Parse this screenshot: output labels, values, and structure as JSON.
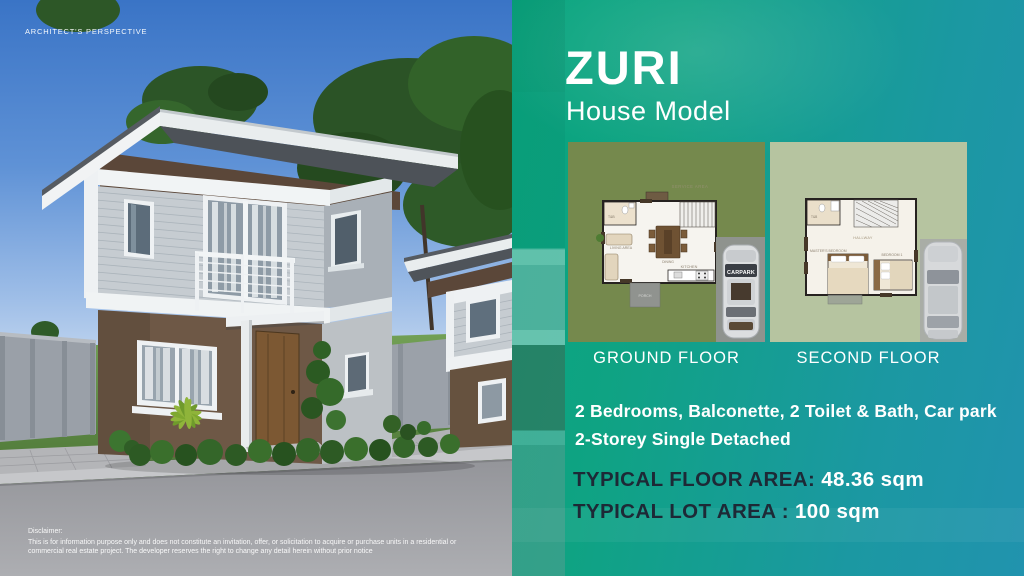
{
  "colors": {
    "panel_gradient_start": "#07a57d",
    "panel_gradient_end": "#2193ae",
    "area_label_dark": "#1d2936",
    "sky_blue": "#3a74c6",
    "ground_plan_bg": "#75894d",
    "second_plan_bg": "#b6c4a0"
  },
  "left_panel": {
    "corner_label": "ARCHITECT'S PERSPECTIVE",
    "disclaimer_title": "Disclaimer:",
    "disclaimer_body": "This is for information purpose only and does not constitute an invitation, offer, or solicitation to acquire or purchase units in a residential or commercial real estate project. The developer reserves the right to change any detail herein without prior notice"
  },
  "right_panel": {
    "title": "ZURI",
    "subtitle": "House Model",
    "floor_plans": [
      {
        "label": "GROUND FLOOR",
        "rooms": {
          "service": "SERVICE AREA",
          "tb": "T&B",
          "living": "LIVING AREA",
          "dining": "DINING",
          "kitchen": "KITCHEN",
          "porch": "PORCH",
          "carpark": "CARPARK"
        }
      },
      {
        "label": "SECOND FLOOR",
        "rooms": {
          "tb": "T&B",
          "hallway": "HALLWAY",
          "master": "MASTER'S BEDROOM",
          "bedroom1": "BEDROOM 1"
        }
      }
    ],
    "features": [
      "2 Bedrooms, Balconette, 2 Toilet & Bath, Car park",
      "2-Storey Single Detached"
    ],
    "areas": [
      {
        "label": "TYPICAL FLOOR AREA:",
        "value": "48.36 sqm"
      },
      {
        "label": "TYPICAL LOT AREA :",
        "value": "100 sqm"
      }
    ]
  }
}
